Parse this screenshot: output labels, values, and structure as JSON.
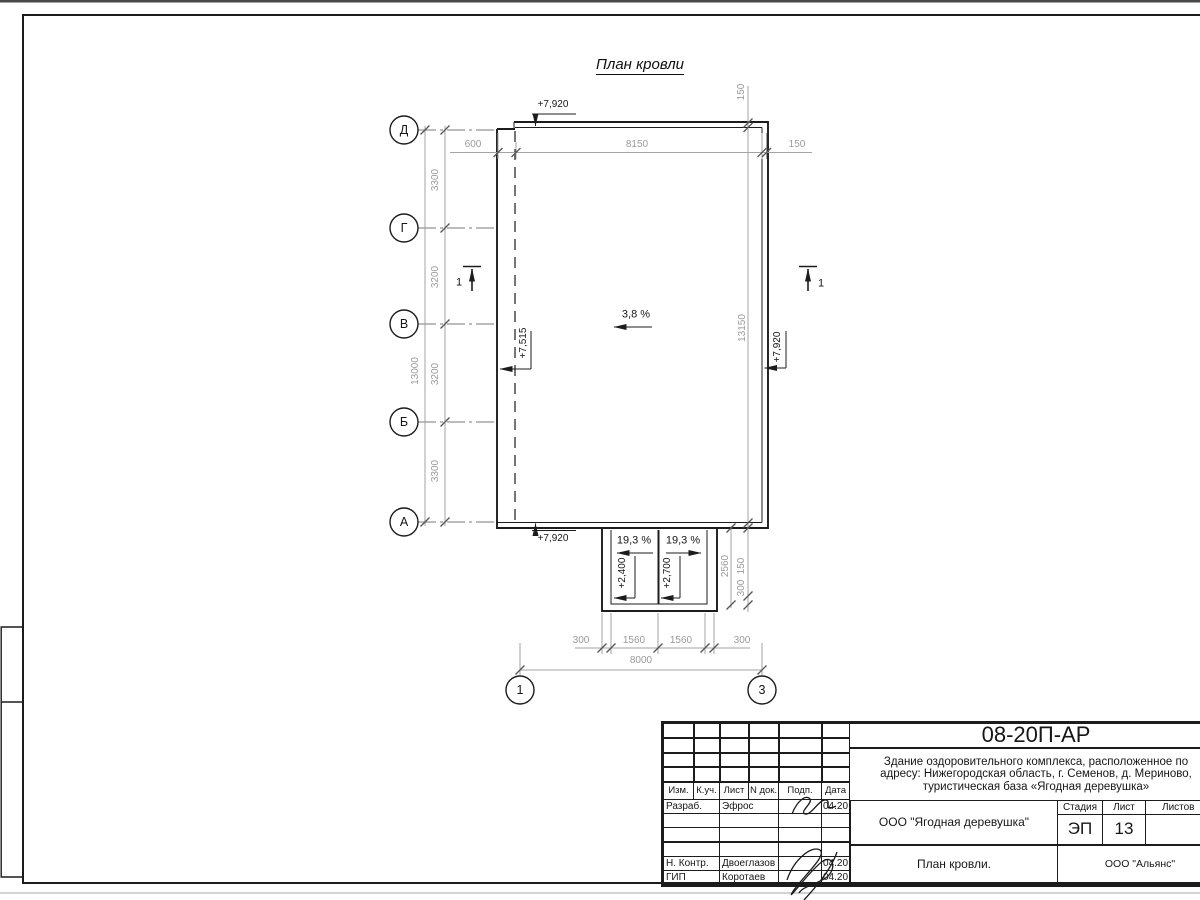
{
  "colors": {
    "line": "#1c1c1c",
    "dim_gray": "#9e9e9e",
    "top_band": "#484848"
  },
  "drawing": {
    "title": "План кровли",
    "slopes": {
      "main": "3,8 %",
      "annex_left": "19,3 %",
      "annex_right": "19,3 %"
    },
    "elevations": {
      "top": "+7,920",
      "left": "+7,515",
      "right": "+7,920",
      "bottom": "+7,920",
      "annex_left": "+2,400",
      "annex_right": "+2,700"
    },
    "axes": {
      "left": [
        "Д",
        "Г",
        "В",
        "Б",
        "А"
      ],
      "bottom": [
        "1",
        "3"
      ]
    },
    "section_marks": {
      "left": "1",
      "right": "1"
    },
    "dimensions": {
      "top": [
        "600",
        "8150",
        "150"
      ],
      "right": [
        "150",
        "13150",
        "2560",
        "150",
        "300"
      ],
      "left": [
        "3300",
        "3200",
        "3200",
        "3300",
        "13000"
      ],
      "bottom": [
        "300",
        "1560",
        "1560",
        "300",
        "8000"
      ]
    }
  },
  "titleblock": {
    "doc_number": "08-20П-АР",
    "project_name_lines": [
      "Здание оздоровительного комплекса, расположенное по",
      "адресу: Нижегородская область, г. Семенов, д. Мериново,",
      "туристическая база «Ягодная деревушка»"
    ],
    "client": "ООО \"Ягодная деревушка\"",
    "sheet_name": "План кровли.",
    "organization": "ООО \"Альянс\"",
    "stage_label": "Стадия",
    "sheet_label": "Лист",
    "sheets_label": "Листов",
    "stage": "ЭП",
    "sheet_number": "13",
    "sheets_total": "",
    "header_cols": [
      "Изм.",
      "К.уч.",
      "Лист",
      "N док.",
      "Подп.",
      "Дата"
    ],
    "rows": [
      {
        "role": "Разраб.",
        "name": "Эфрос",
        "date": "04.20"
      },
      {
        "role": "",
        "name": "",
        "date": ""
      },
      {
        "role": "",
        "name": "",
        "date": ""
      },
      {
        "role": "",
        "name": "",
        "date": ""
      },
      {
        "role": "Н. Контр.",
        "name": "Двоеглазов",
        "date": "04.20"
      },
      {
        "role": "ГИП",
        "name": "Коротаев",
        "date": "04.20"
      }
    ]
  }
}
